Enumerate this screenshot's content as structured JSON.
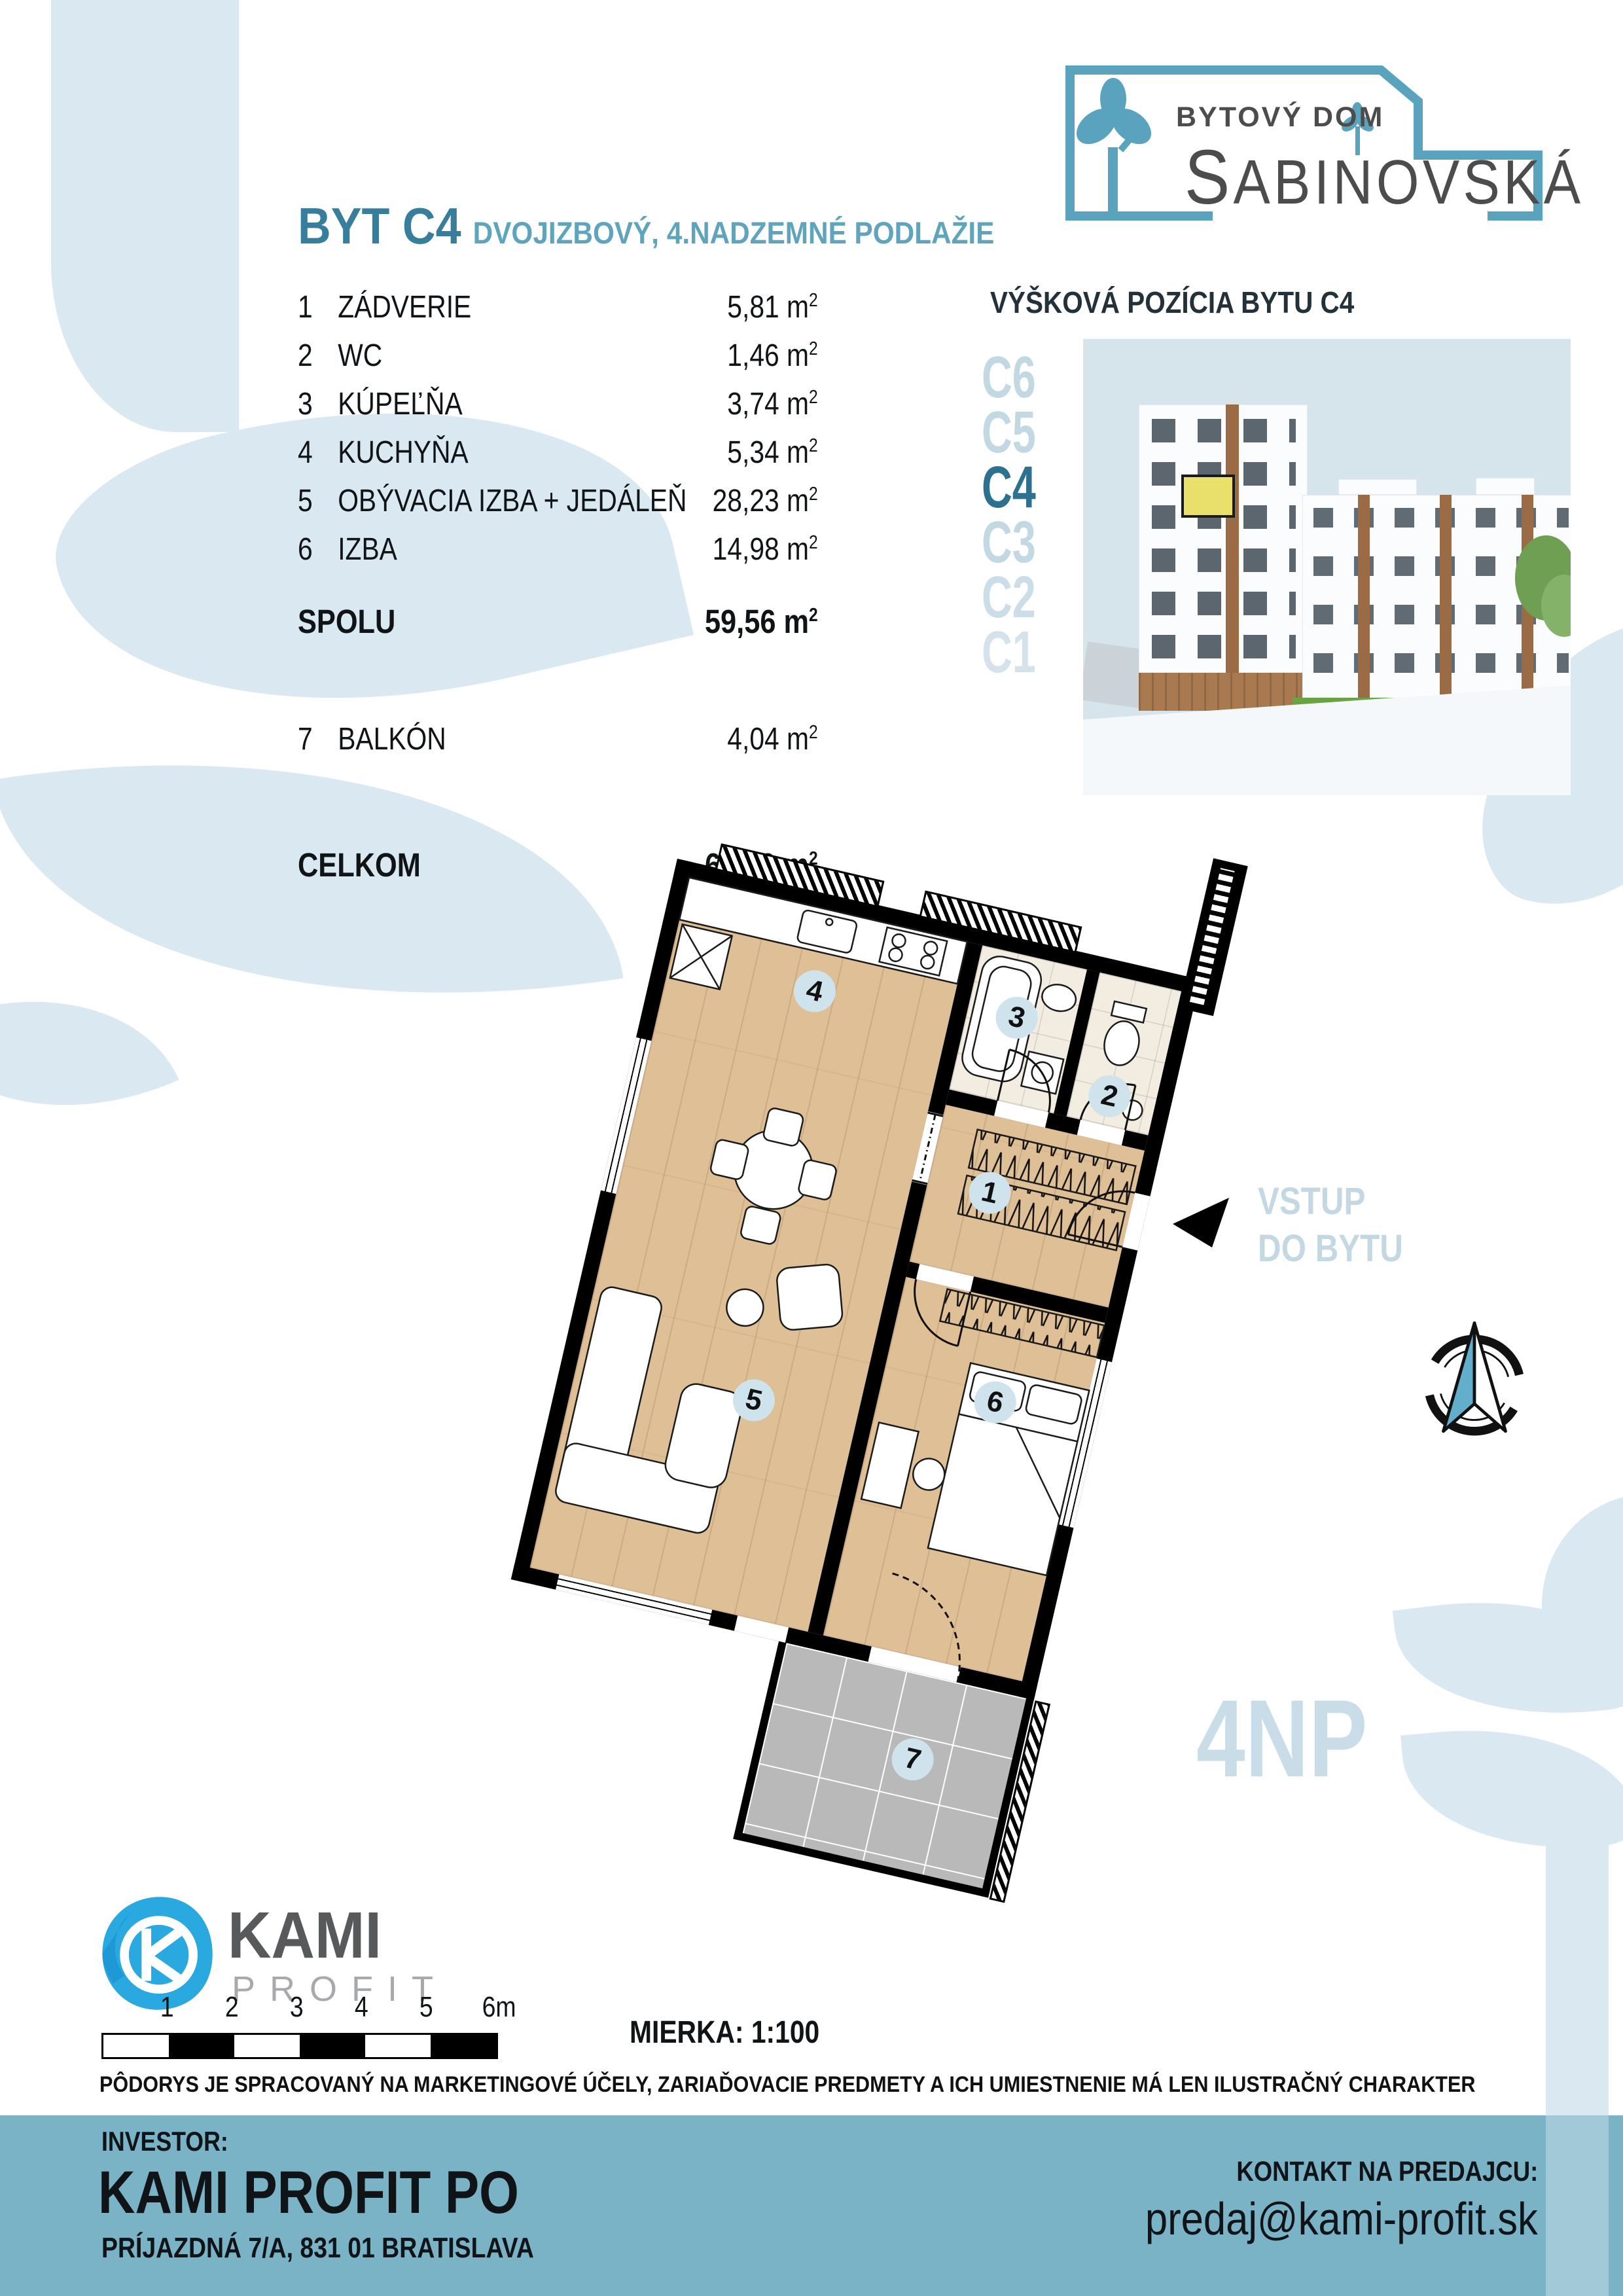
{
  "brand": {
    "tagline": "BYTOVÝ DOM",
    "name": "SABINOVSKÁ"
  },
  "title": {
    "main": "BYT C4",
    "subtitle": "DVOJIZBOVÝ, 4.NADZEMNÉ PODLAŽIE"
  },
  "room_table": {
    "unit": "m",
    "unit_sup": "2",
    "rows": [
      {
        "num": "1",
        "name": "ZÁDVERIE",
        "area": "5,81"
      },
      {
        "num": "2",
        "name": "WC",
        "area": "1,46"
      },
      {
        "num": "3",
        "name": "KÚPEĽŇA",
        "area": "3,74"
      },
      {
        "num": "4",
        "name": "KUCHYŇA",
        "area": "5,34"
      },
      {
        "num": "5",
        "name": "OBÝVACIA IZBA + JEDÁLEŇ",
        "area": "28,23"
      },
      {
        "num": "6",
        "name": "IZBA",
        "area": "14,98"
      }
    ],
    "subtotal": {
      "label": "SPOLU",
      "area": "59,56"
    },
    "balcony": {
      "num": "7",
      "name": "BALKÓN",
      "area": "4,04"
    },
    "total": {
      "label": "CELKOM",
      "area": "63,60"
    }
  },
  "elevation": {
    "title": "VÝŠKOVÁ POZÍCIA BYTU C4",
    "floors": [
      "C6",
      "C5",
      "C4",
      "C3",
      "C2",
      "C1"
    ],
    "highlighted_floor": "C4"
  },
  "plan": {
    "room_numbers": [
      "1",
      "2",
      "3",
      "4",
      "5",
      "6",
      "7"
    ],
    "entrance_line1": "VSTUP",
    "entrance_line2": "DO BYTU",
    "floor_code": "4NP"
  },
  "kami_logo": {
    "name": "KAMI",
    "suffix": "PROFIT"
  },
  "scale": {
    "ticks": [
      "1",
      "2",
      "3",
      "4",
      "5",
      "6m"
    ],
    "label": "MIERKA: 1:100"
  },
  "disclaimer": "PÔDORYS JE SPRACOVANÝ NA MARKETINGOVÉ ÚČELY, ZARIAĎOVACIE PREDMETY A ICH UMIESTNENIE MÁ LEN ILUSTRAČNÝ CHARAKTER",
  "footer": {
    "investor_label": "INVESTOR:",
    "investor_name": "KAMI PROFIT PO",
    "investor_address": "PRÍJAZDNÁ 7/A, 831 01 BRATISLAVA",
    "contact_label": "KONTAKT NA PREDAJCU:",
    "contact_email": "predaj@kami-profit.sk"
  },
  "colors": {
    "accent_teal": "#377d9c",
    "accent_teal_light": "#5fa4bd",
    "footer_blue": "#7ab2c6",
    "decor_blue": "#d9e8f1",
    "plan_badge_blue": "#cfe3ed",
    "wood": "#debf96",
    "kami_blue": "#29a9e0",
    "highlight_yellow": "#e8e06a",
    "logo_blue": "#5aa3bf"
  }
}
